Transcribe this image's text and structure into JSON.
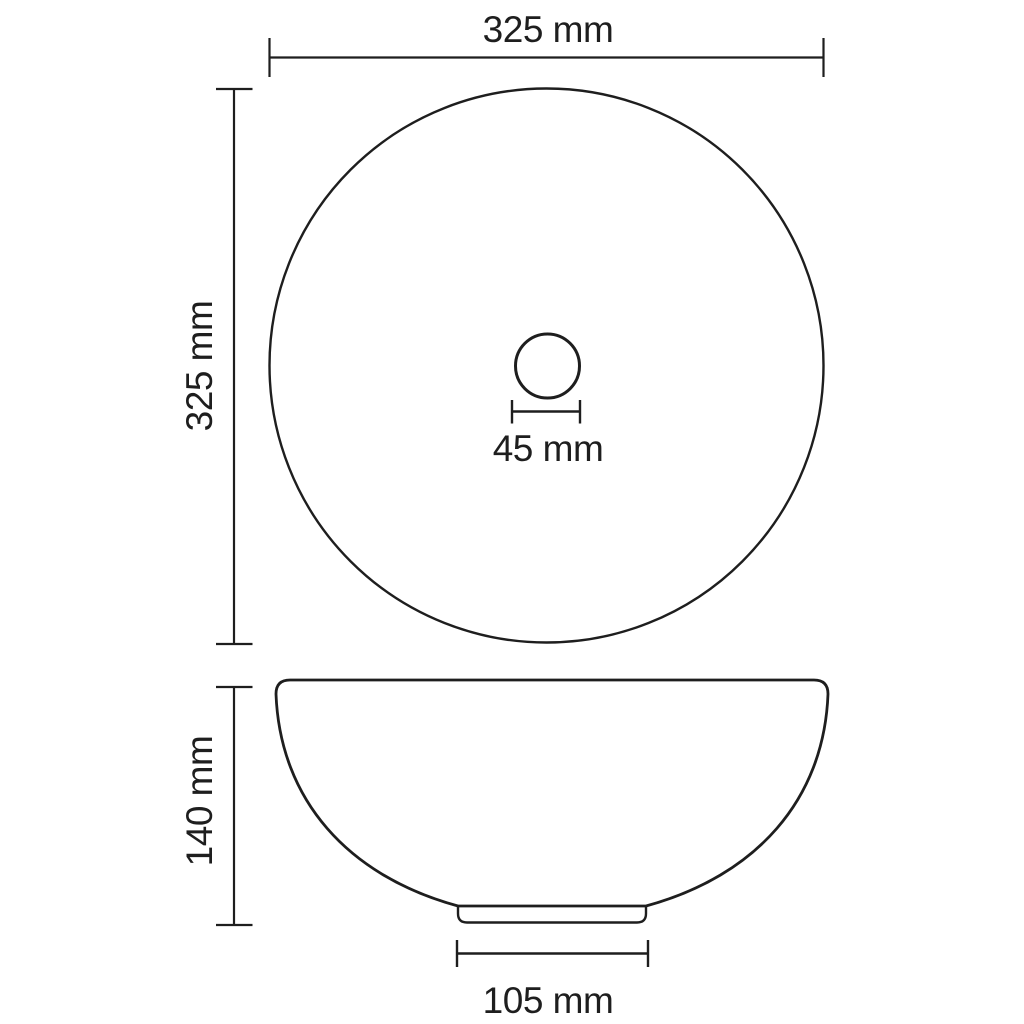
{
  "diagram": {
    "background_color": "#ffffff",
    "line_color": "#1e1e1e",
    "views": {
      "top_view": "round basin seen from above with centered drain hole",
      "side_view": "bowl profile with small base foot"
    },
    "labels": {
      "top_width": "325 mm",
      "left_height": "325 mm",
      "drain_diameter": "45 mm",
      "bowl_height": "140 mm",
      "base_width": "105 mm"
    }
  }
}
